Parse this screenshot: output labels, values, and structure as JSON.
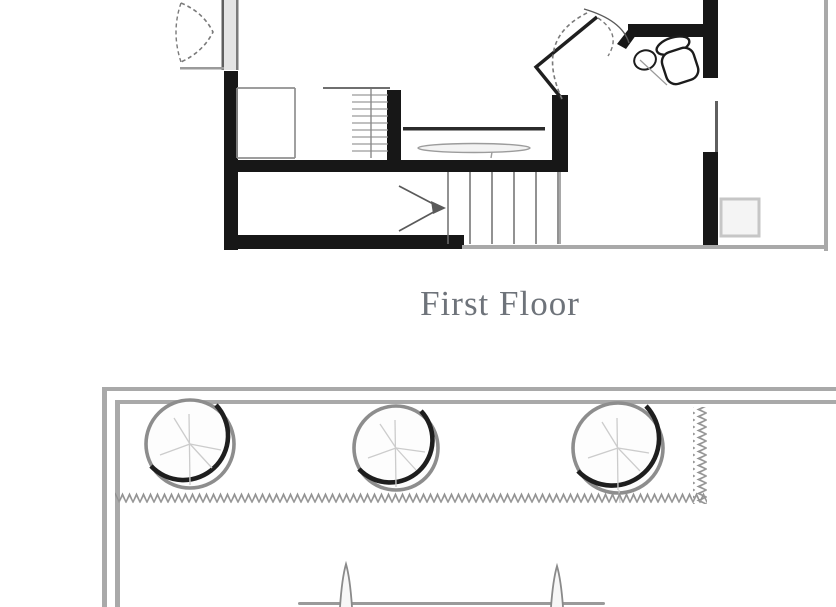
{
  "page": {
    "background_color": "#ffffff"
  },
  "first_floor": {
    "label": "First Floor",
    "label_color": "#6e737a",
    "wall_color": "#171717",
    "thin_line_color": "#8f8f8f",
    "boundary_color": "#a9a9a9",
    "fixtures": [
      "bifold-door",
      "double-door",
      "toilet",
      "sink",
      "closet",
      "shelves",
      "counter",
      "staircase",
      "stair-direction-arrow",
      "porch-square"
    ]
  },
  "site_plan": {
    "tree_count": 3,
    "line_color": "#a9a9a9",
    "hatch_color": "#8f8f8f",
    "furniture": [
      "table",
      "plant",
      "plant"
    ]
  }
}
